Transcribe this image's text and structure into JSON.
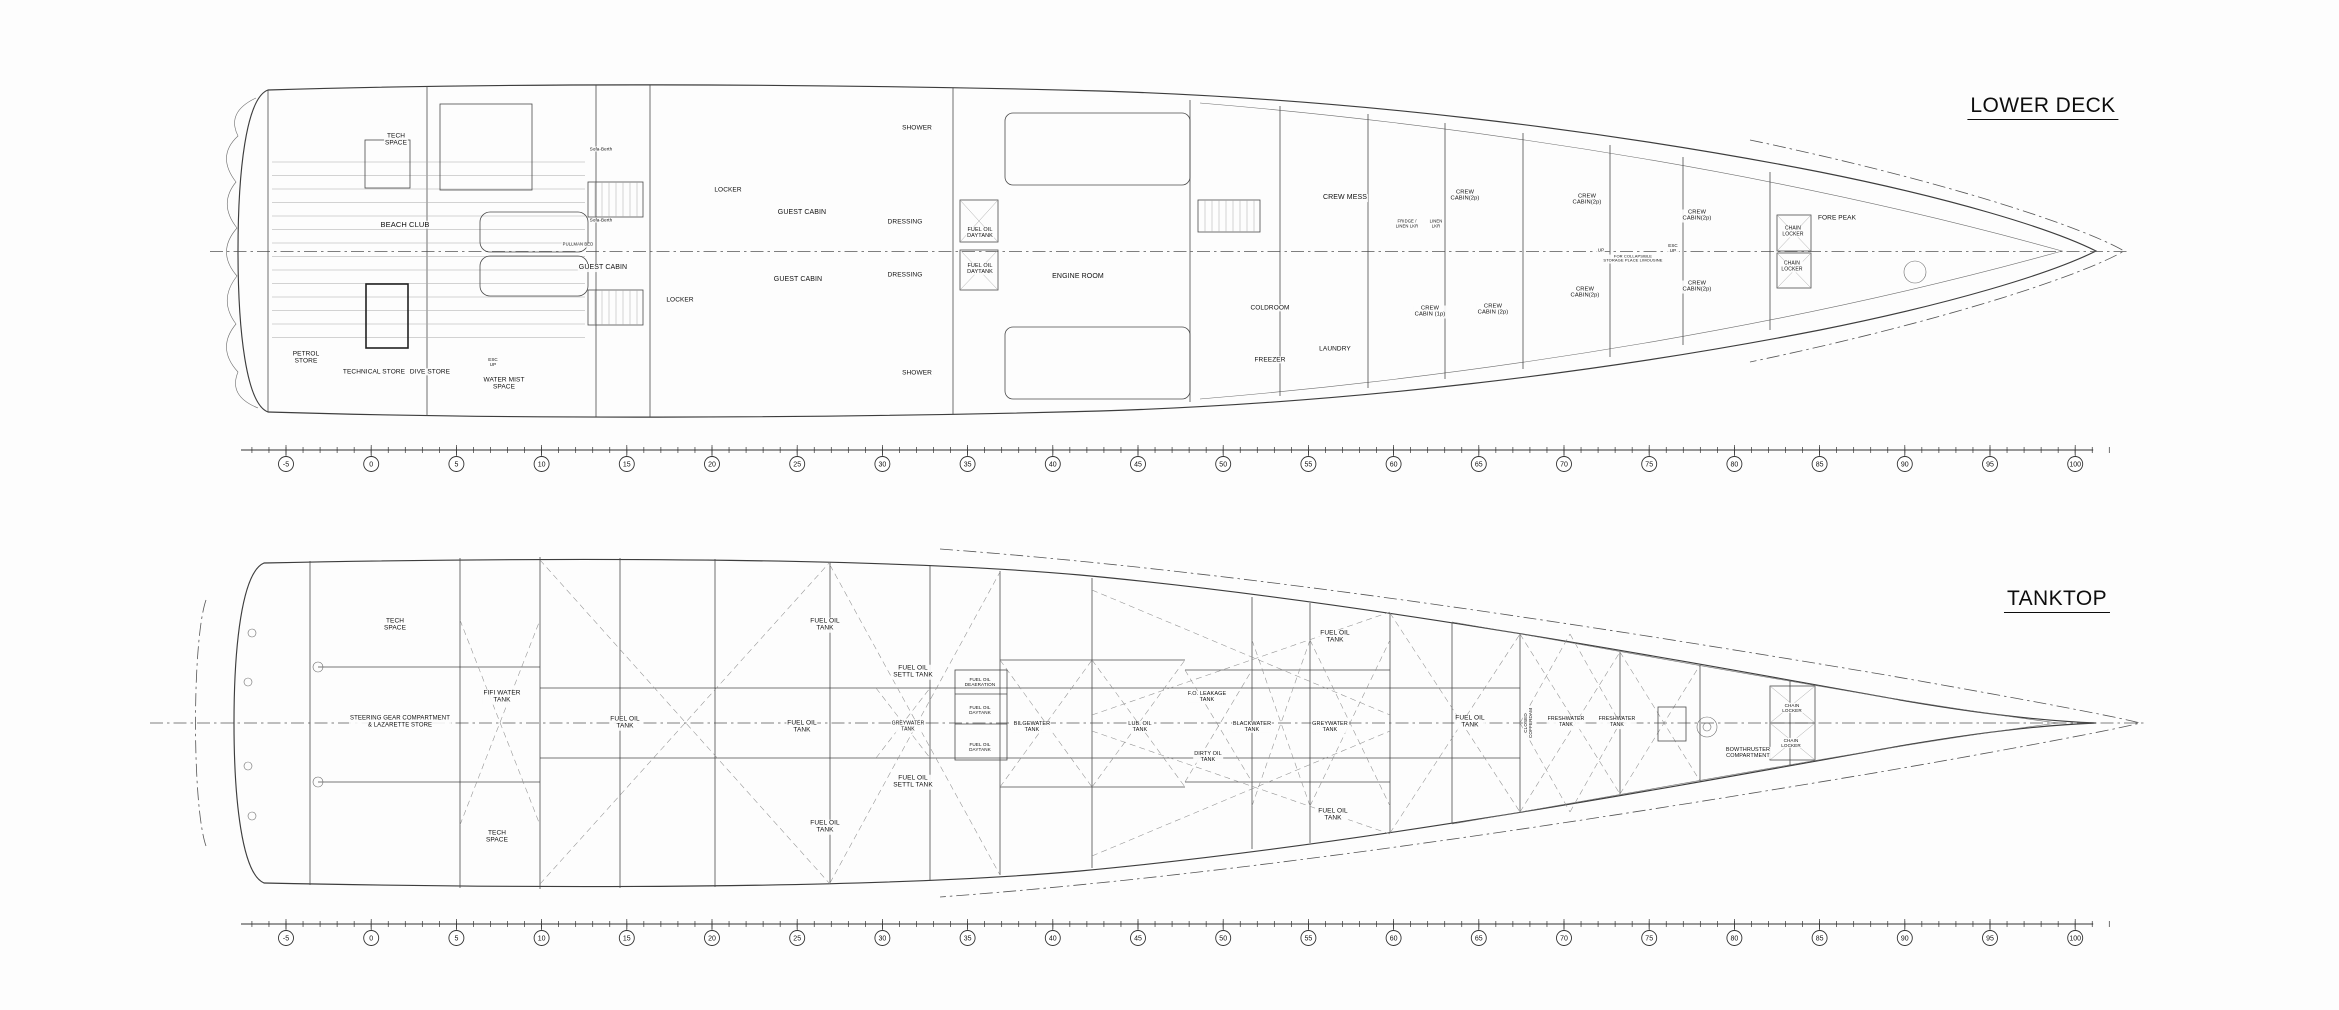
{
  "drawing": {
    "background": "#fdfdfd",
    "line_color": "#3d3d3d"
  },
  "decks": [
    {
      "id": "lower-deck",
      "title": "LOWER DECK",
      "title_x": 2043,
      "title_y": 107,
      "ruler": {
        "y_line": 450,
        "y_circle": 464,
        "x_start": 286,
        "step_px": 85.2,
        "frames": [
          "-5",
          "0",
          "5",
          "10",
          "15",
          "20",
          "25",
          "30",
          "35",
          "40",
          "45",
          "50",
          "55",
          "60",
          "65",
          "70",
          "75",
          "80",
          "85",
          "90",
          "95",
          "100"
        ]
      },
      "labels": [
        {
          "t": "TECH\nSPACE",
          "x": 396,
          "y": 140
        },
        {
          "t": "BEACH CLUB",
          "x": 405,
          "y": 225,
          "s": 7.5
        },
        {
          "t": "PETROL\nSTORE",
          "x": 306,
          "y": 358
        },
        {
          "t": "TECHNICAL STORE",
          "x": 374,
          "y": 372
        },
        {
          "t": "DIVE STORE",
          "x": 430,
          "y": 372
        },
        {
          "t": "ESC\nUP",
          "x": 493,
          "y": 362,
          "s": 4.5
        },
        {
          "t": "WATER MIST\nSPACE",
          "x": 504,
          "y": 384
        },
        {
          "t": "Sofa-Berth",
          "x": 601,
          "y": 149,
          "s": 4.5
        },
        {
          "t": "Sofa-Berth",
          "x": 601,
          "y": 220,
          "s": 4.5
        },
        {
          "t": "PULLMAN BED",
          "x": 578,
          "y": 245,
          "s": 4.2
        },
        {
          "t": "GUEST CABIN",
          "x": 603,
          "y": 268,
          "s": 7
        },
        {
          "t": "LOCKER",
          "x": 728,
          "y": 190
        },
        {
          "t": "LOCKER",
          "x": 680,
          "y": 300
        },
        {
          "t": "GUEST CABIN",
          "x": 802,
          "y": 213,
          "s": 7
        },
        {
          "t": "GUEST CABIN",
          "x": 798,
          "y": 280,
          "s": 7
        },
        {
          "t": "SHOWER",
          "x": 917,
          "y": 128
        },
        {
          "t": "SHOWER",
          "x": 917,
          "y": 373
        },
        {
          "t": "DRESSING",
          "x": 905,
          "y": 222
        },
        {
          "t": "DRESSING",
          "x": 905,
          "y": 275
        },
        {
          "t": "FUEL OIL\nDAYTANK",
          "x": 980,
          "y": 233,
          "s": 5.5
        },
        {
          "t": "FUEL OIL\nDAYTANK",
          "x": 980,
          "y": 269,
          "s": 5.5
        },
        {
          "t": "ENGINE ROOM",
          "x": 1078,
          "y": 277,
          "s": 7
        },
        {
          "t": "CREW MESS",
          "x": 1345,
          "y": 198,
          "s": 7
        },
        {
          "t": "COLDROOM",
          "x": 1270,
          "y": 308
        },
        {
          "t": "FREEZER",
          "x": 1270,
          "y": 360
        },
        {
          "t": "LAUNDRY",
          "x": 1335,
          "y": 349
        },
        {
          "t": "FRIDGE /\nLINEN LKR",
          "x": 1407,
          "y": 224,
          "s": 4.2
        },
        {
          "t": "LINEN\nLKR",
          "x": 1436,
          "y": 224,
          "s": 4.2
        },
        {
          "t": "CREW\nCABIN(2p)",
          "x": 1465,
          "y": 196,
          "s": 5.8
        },
        {
          "t": "CREW\nCABIN (1p)",
          "x": 1430,
          "y": 312,
          "s": 5.8
        },
        {
          "t": "CREW\nCABIN (2p)",
          "x": 1493,
          "y": 310,
          "s": 5.8
        },
        {
          "t": "CREW\nCABIN(2p)",
          "x": 1587,
          "y": 200,
          "s": 5.8
        },
        {
          "t": "CREW\nCABIN(2p)",
          "x": 1585,
          "y": 293,
          "s": 5.8
        },
        {
          "t": "UP",
          "x": 1601,
          "y": 250,
          "s": 4.5
        },
        {
          "t": "FOR COLLAPSIBLE\nSTORAGE PLACE LIMOUSINE",
          "x": 1633,
          "y": 259,
          "s": 4
        },
        {
          "t": "ESC\nUP",
          "x": 1673,
          "y": 248,
          "s": 4.5
        },
        {
          "t": "CREW\nCABIN(2p)",
          "x": 1697,
          "y": 216,
          "s": 5.8
        },
        {
          "t": "CREW\nCABIN(2p)",
          "x": 1697,
          "y": 287,
          "s": 5.8
        },
        {
          "t": "CHAIN\nLOCKER",
          "x": 1793,
          "y": 232,
          "s": 5
        },
        {
          "t": "CHAIN\nLOCKER",
          "x": 1792,
          "y": 267,
          "s": 5
        },
        {
          "t": "FORE PEAK",
          "x": 1837,
          "y": 218
        }
      ]
    },
    {
      "id": "tanktop",
      "title": "TANKTOP",
      "title_x": 2057,
      "title_y": 600,
      "ruler": {
        "y_line": 924,
        "y_circle": 938,
        "x_start": 286,
        "step_px": 85.2,
        "frames": [
          "-5",
          "0",
          "5",
          "10",
          "15",
          "20",
          "25",
          "30",
          "35",
          "40",
          "45",
          "50",
          "55",
          "60",
          "65",
          "70",
          "75",
          "80",
          "85",
          "90",
          "95",
          "100"
        ]
      },
      "labels": [
        {
          "t": "TECH\nSPACE",
          "x": 395,
          "y": 625
        },
        {
          "t": "STEERING GEAR COMPARTMENT\n& LAZARETTE STORE",
          "x": 400,
          "y": 722,
          "s": 6
        },
        {
          "t": "FIFI WATER\nTANK",
          "x": 502,
          "y": 697
        },
        {
          "t": "TECH\nSPACE",
          "x": 497,
          "y": 837
        },
        {
          "t": "FUEL OIL\nTANK",
          "x": 625,
          "y": 723
        },
        {
          "t": "FUEL OIL\nTANK",
          "x": 825,
          "y": 625
        },
        {
          "t": "FUEL OIL\nSETTL TANK",
          "x": 913,
          "y": 672
        },
        {
          "t": "FUEL OIL\nTANK",
          "x": 802,
          "y": 727
        },
        {
          "t": "GREYWATER\nTANK",
          "x": 908,
          "y": 727,
          "s": 5
        },
        {
          "t": "FUEL OIL\nDEAERATION",
          "x": 980,
          "y": 682,
          "s": 4.6
        },
        {
          "t": "FUEL OIL\nDAYTANK",
          "x": 980,
          "y": 710,
          "s": 4.6
        },
        {
          "t": "FUEL OIL\nDAYTANK",
          "x": 980,
          "y": 747,
          "s": 4.6
        },
        {
          "t": "FUEL OIL\nSETTL TANK",
          "x": 913,
          "y": 782
        },
        {
          "t": "FUEL OIL\nTANK",
          "x": 825,
          "y": 827
        },
        {
          "t": "BILGEWATER\nTANK",
          "x": 1032,
          "y": 727,
          "s": 5.5
        },
        {
          "t": "LUB. OIL\nTANK",
          "x": 1140,
          "y": 727,
          "s": 5.5
        },
        {
          "t": "F.O. LEAKAGE\nTANK",
          "x": 1207,
          "y": 697,
          "s": 5.5
        },
        {
          "t": "DIRTY OIL\nTANK",
          "x": 1208,
          "y": 757,
          "s": 5.5
        },
        {
          "t": "BLACKWATER\nTANK",
          "x": 1252,
          "y": 727,
          "s": 5.5
        },
        {
          "t": "GREYWATER\nTANK",
          "x": 1330,
          "y": 727,
          "s": 5.5
        },
        {
          "t": "FUEL OIL\nTANK",
          "x": 1335,
          "y": 637
        },
        {
          "t": "FUEL OIL\nTANK",
          "x": 1333,
          "y": 815
        },
        {
          "t": "FUEL OIL\nTANK",
          "x": 1470,
          "y": 722
        },
        {
          "t": "CLOSED\nCOFFERDAM",
          "x": 1528,
          "y": 723,
          "s": 4.6,
          "r": -90
        },
        {
          "t": "FRESHWATER\nTANK",
          "x": 1566,
          "y": 723,
          "s": 5.2
        },
        {
          "t": "FRESHWATER\nTANK",
          "x": 1617,
          "y": 723,
          "s": 5.2
        },
        {
          "t": "BOWTHRUSTER\nCOMPARTMENT",
          "x": 1748,
          "y": 753,
          "s": 5.5
        },
        {
          "t": "CHAIN\nLOCKER",
          "x": 1792,
          "y": 708,
          "s": 4.6
        },
        {
          "t": "CHAIN\nLOCKER",
          "x": 1791,
          "y": 743,
          "s": 4.6
        }
      ]
    }
  ]
}
